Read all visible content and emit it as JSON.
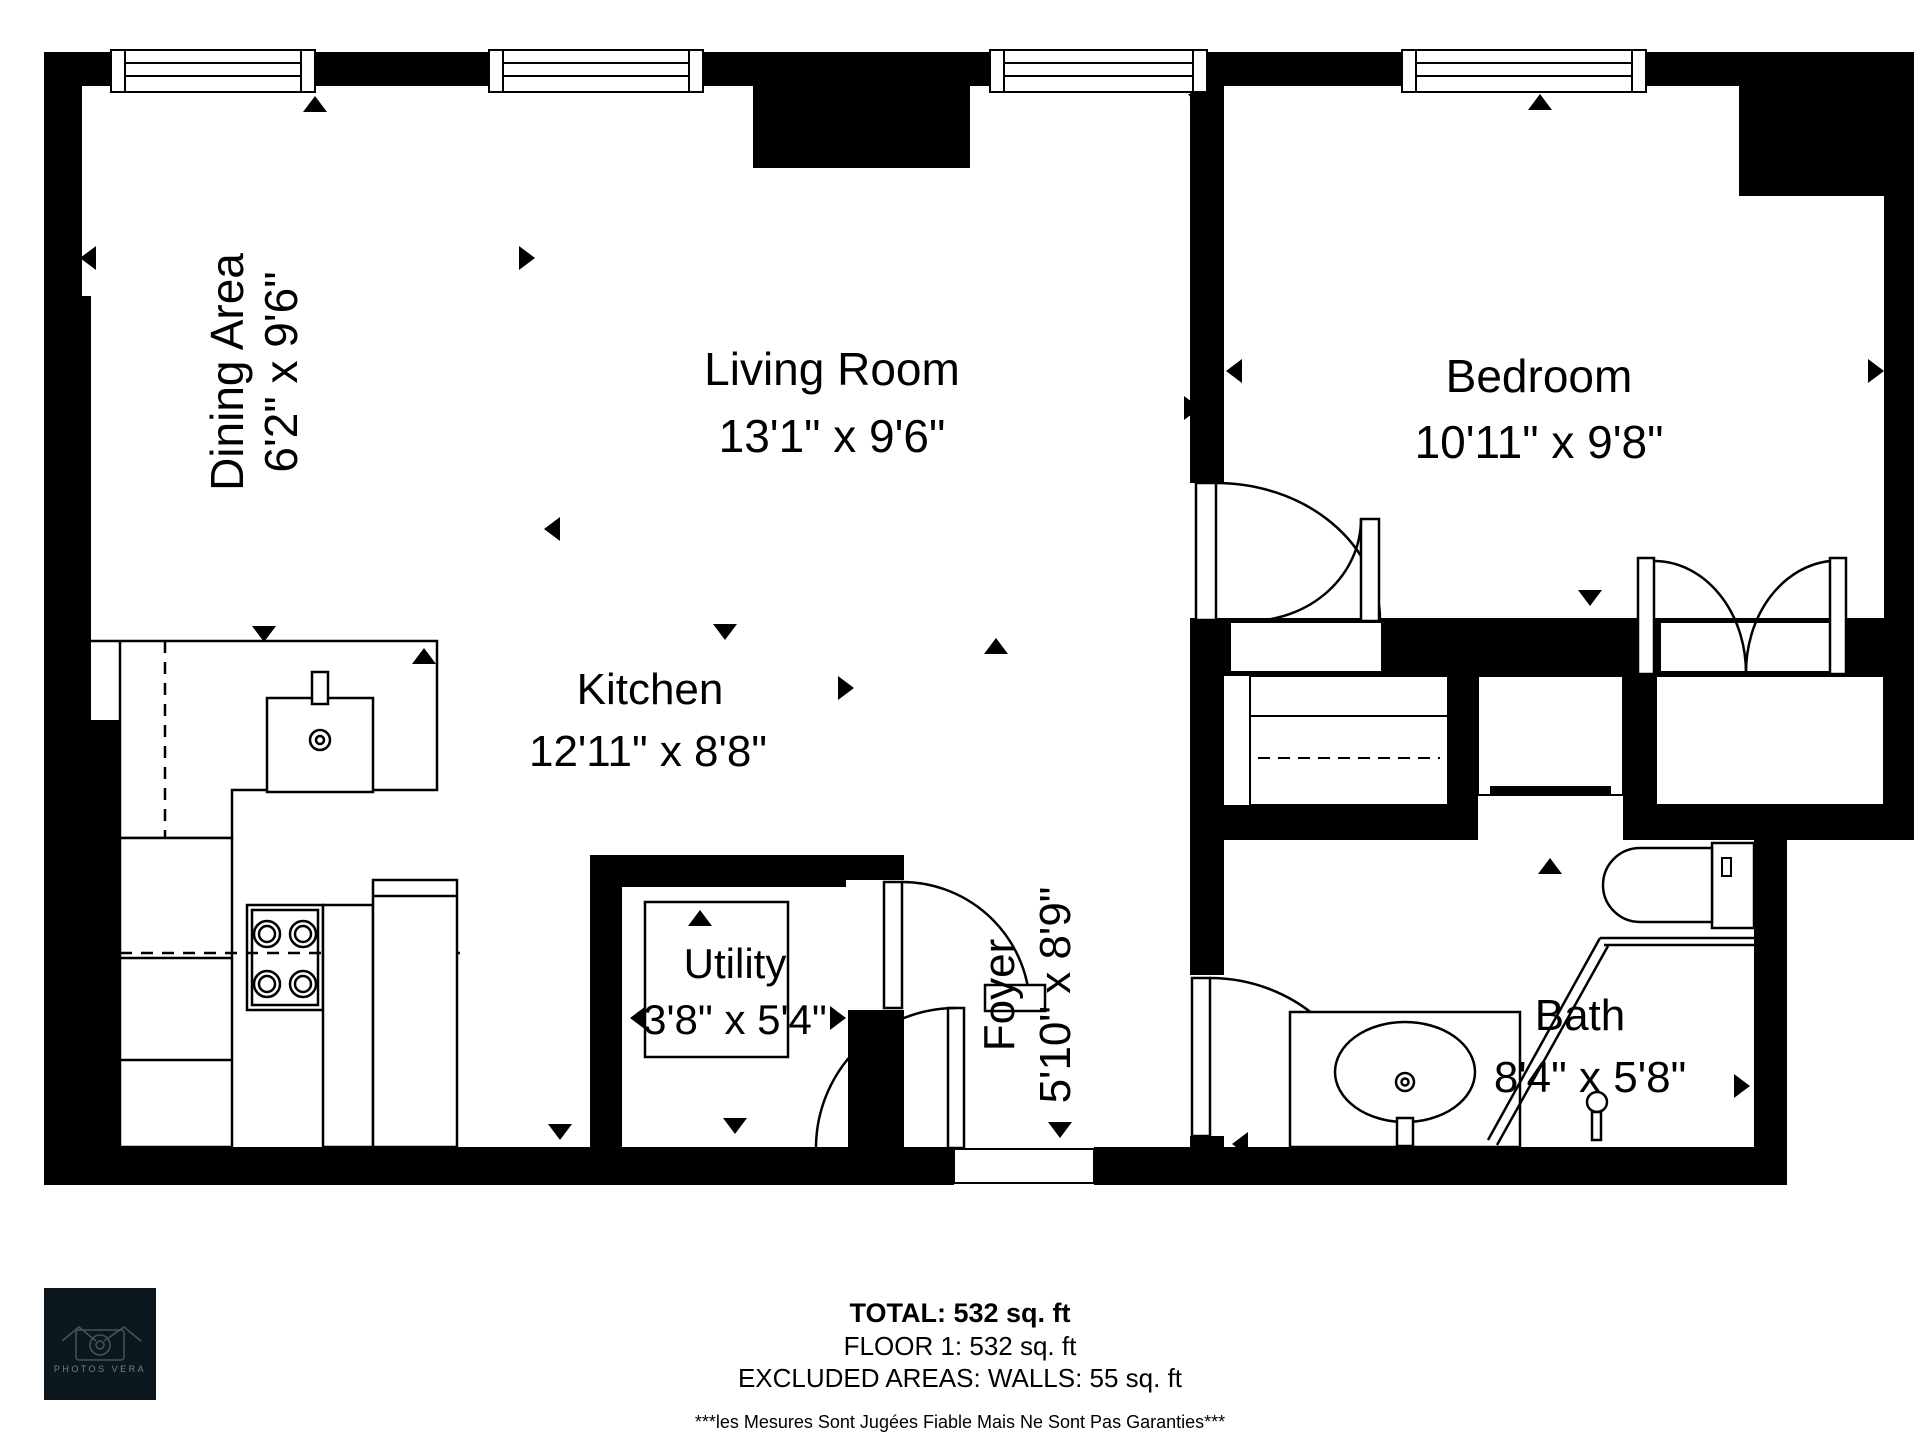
{
  "plan": {
    "rooms": {
      "dining": {
        "name": "Dining Area",
        "dims": "6'2\" x 9'6\""
      },
      "living": {
        "name": "Living Room",
        "dims": "13'1\" x 9'6\""
      },
      "kitchen": {
        "name": "Kitchen",
        "dims": "12'11\" x 8'8\""
      },
      "utility": {
        "name": "Utility",
        "dims": "3'8\" x 5'4\""
      },
      "foyer": {
        "name": "Foyer",
        "dims": "5'10\" x 8'9\""
      },
      "bedroom": {
        "name": "Bedroom",
        "dims": "10'11\" x 9'8\""
      },
      "bath": {
        "name": "Bath",
        "dims": "8'4\" x 5'8\""
      }
    },
    "colors": {
      "wall": "#000000",
      "floor": "#ffffff",
      "logo_bg": "#0d171e"
    }
  },
  "summary": {
    "total": "TOTAL: 532 sq. ft",
    "floor": "FLOOR 1: 532 sq. ft",
    "excluded": "EXCLUDED AREAS: WALLS: 55 sq. ft",
    "disclaimer": "***les Mesures Sont Jugées Fiable Mais Ne Sont Pas Garanties***"
  },
  "logo": {
    "text": "PHOTOS VERA"
  }
}
